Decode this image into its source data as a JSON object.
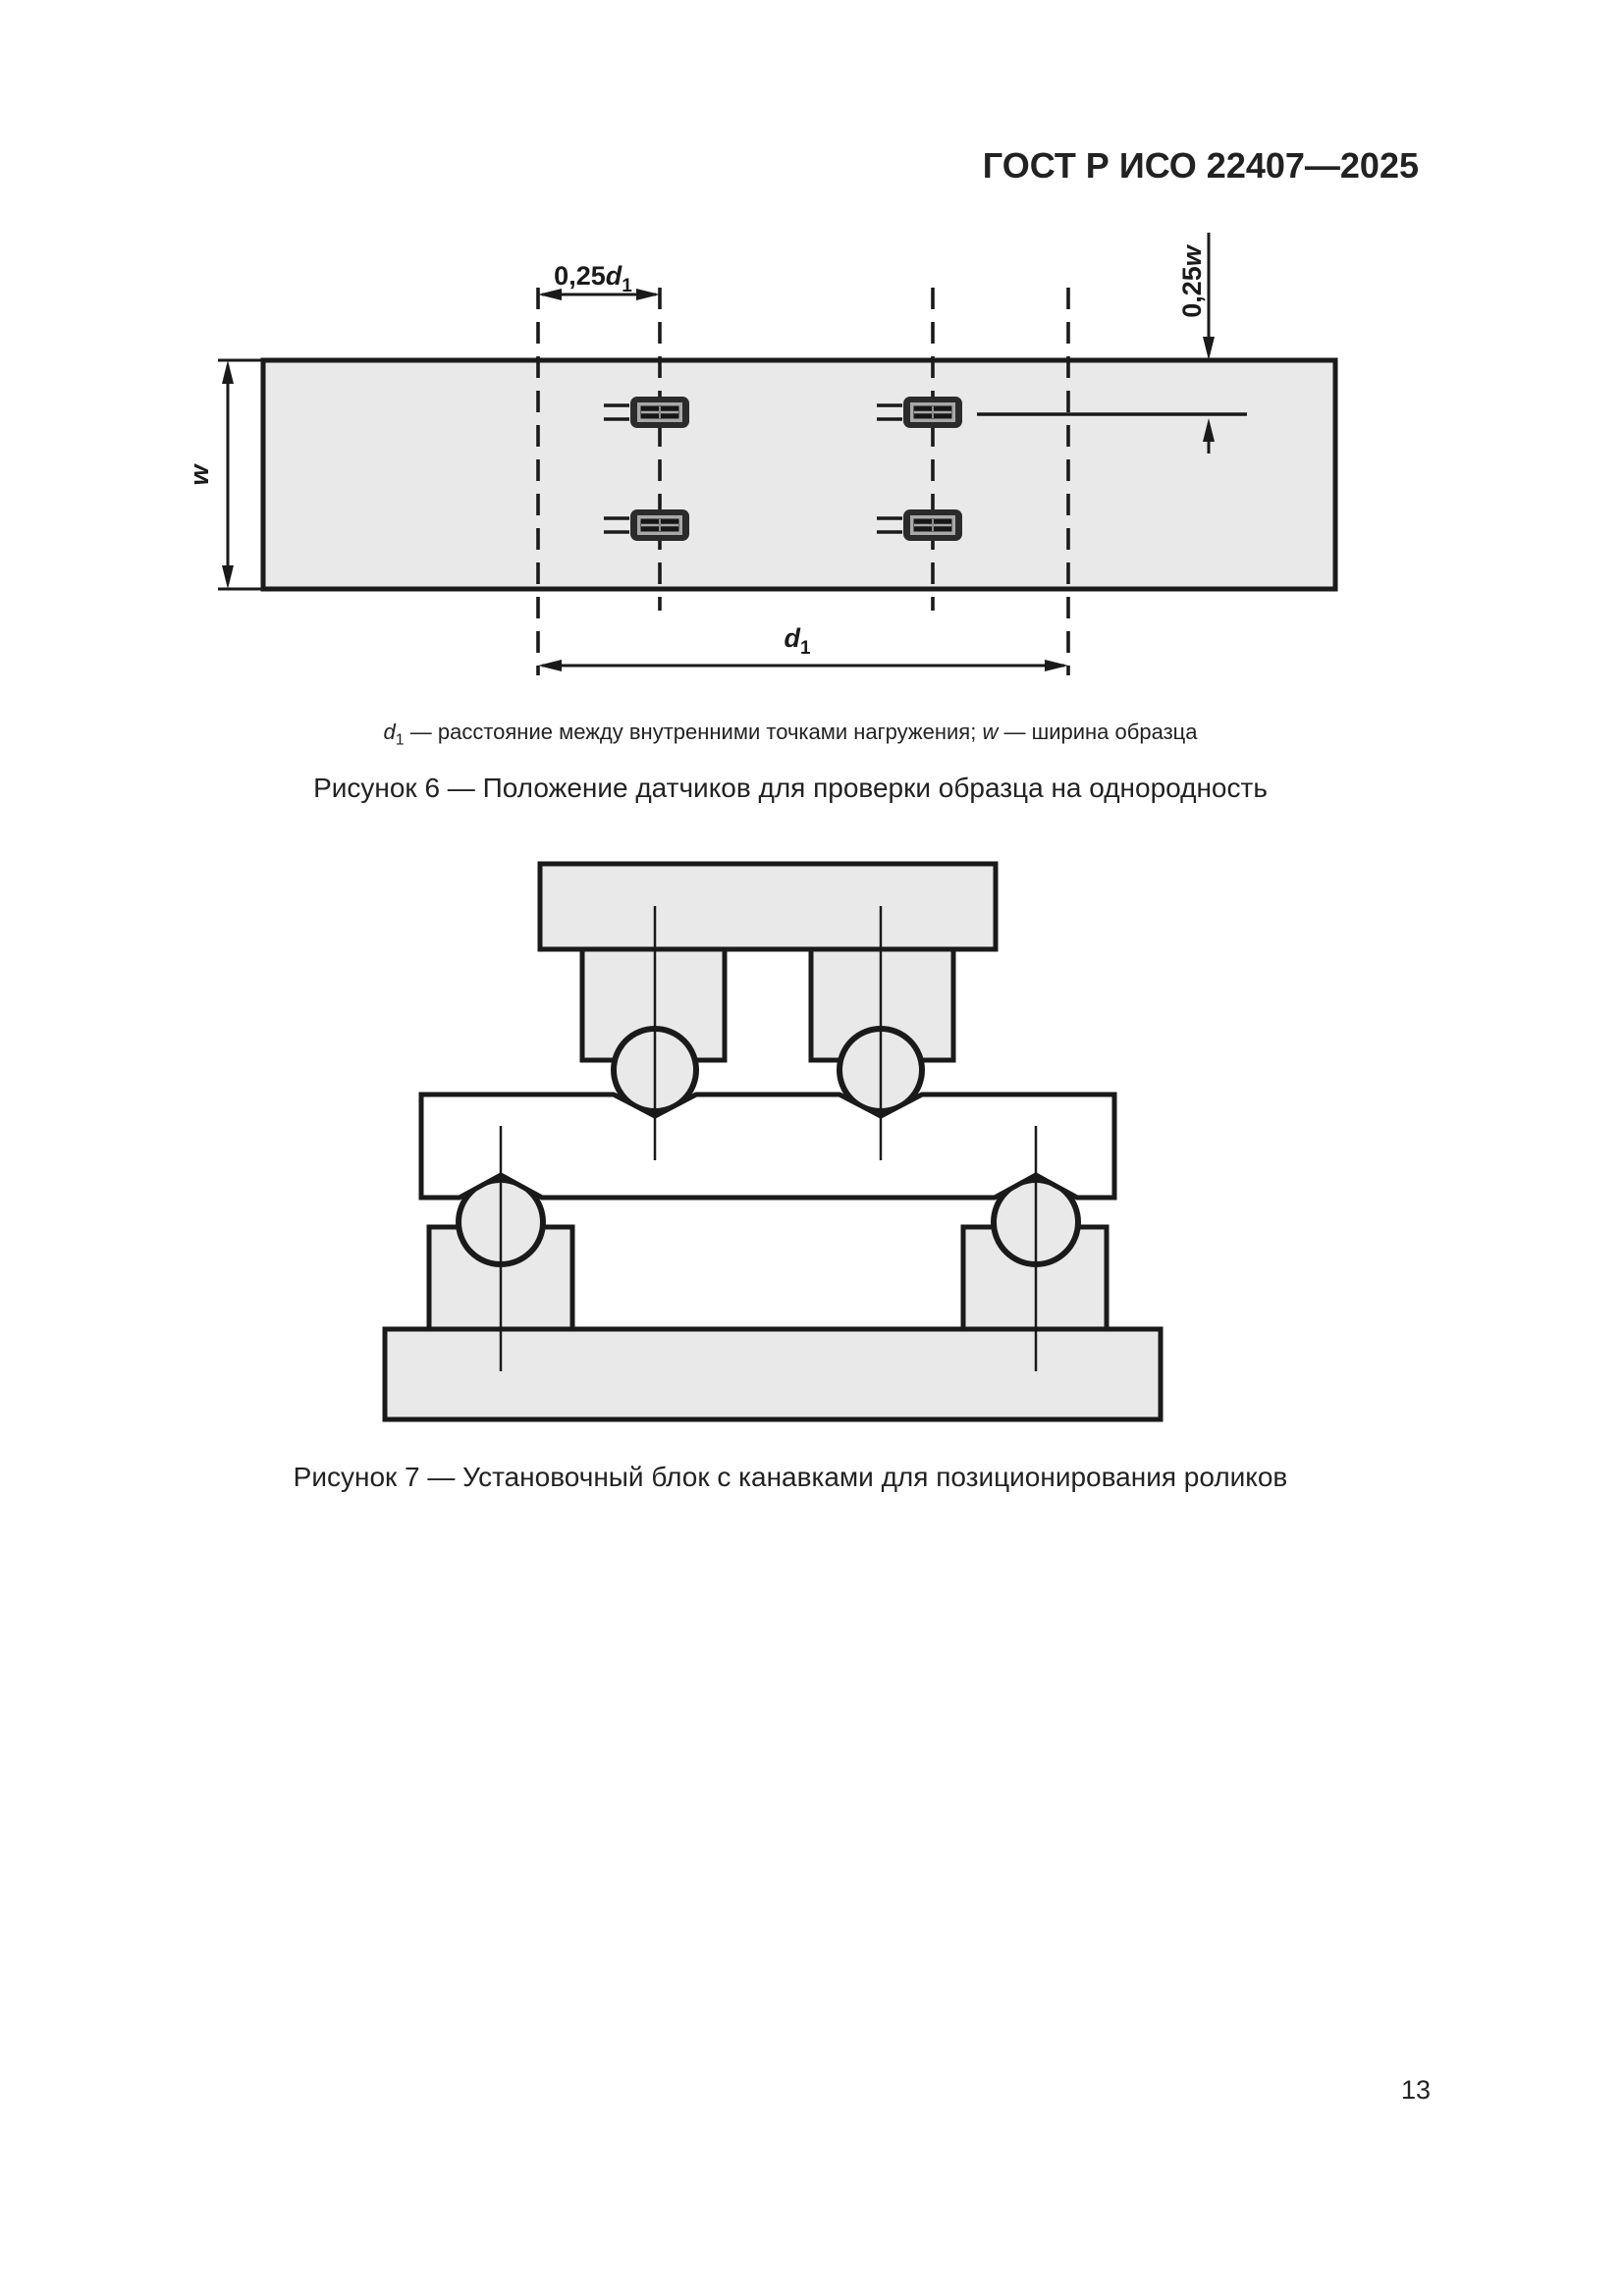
{
  "header": {
    "title": "ГОСТ Р ИСО 22407—2025"
  },
  "figure6": {
    "dims": {
      "d025": {
        "prefix": "0,25",
        "sym": "d",
        "sub": "1"
      },
      "w": {
        "sym": "w"
      },
      "w025": {
        "prefix": "0,25",
        "sym": "w"
      },
      "d1": {
        "sym": "d",
        "sub": "1"
      }
    },
    "legend": {
      "d_sym": "d",
      "d_sub": "1",
      "d_text": " — расстояние между внутренними точками нагружения; ",
      "w_sym": "w",
      "w_text": " — ширина образца"
    },
    "caption": "Рисунок 6 — Положение датчиков для проверки образца на однородность"
  },
  "figure7": {
    "caption": "Рисунок 7 — Установочный блок с канавками для позиционирования роликов"
  },
  "footer": {
    "page_number": "13"
  },
  "colors": {
    "line": "#1a1a1a",
    "specimen_fill": "#e9e9e9",
    "fixture_fill": "#e9e9e9",
    "block_fill": "#ffffff",
    "sensor_body": "#2b2b2b",
    "sensor_inner_frame": "#a8a8a8",
    "sensor_core": "#161616"
  }
}
